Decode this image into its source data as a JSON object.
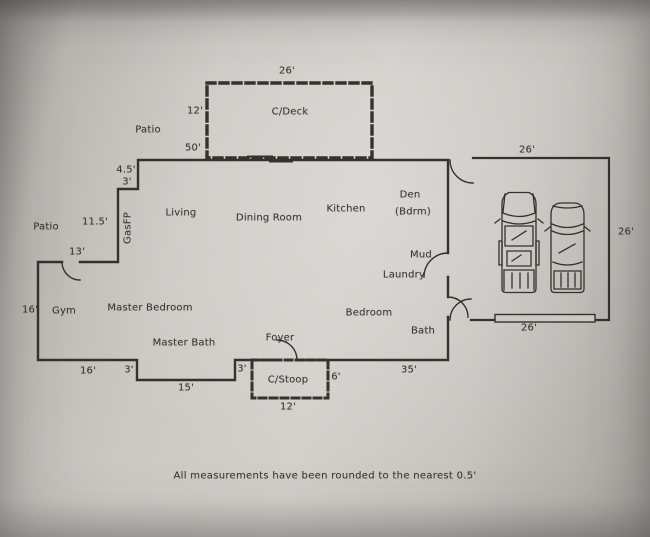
{
  "meta": {
    "disclaimer": "All measurements have been rounded to the nearest  0.5'",
    "palette": {
      "ink": "#37342f",
      "paper": "#ccc9c4"
    },
    "icons": {
      "vehicle_left": "pickup-truck-top-view-icon",
      "vehicle_right": "suv-top-view-icon",
      "doors": "quarter-arc-door-swing"
    }
  },
  "rooms": [
    {
      "id": "patio-top",
      "label": "Patio"
    },
    {
      "id": "c-deck",
      "label": "C/Deck"
    },
    {
      "id": "living",
      "label": "Living"
    },
    {
      "id": "dining-room",
      "label": "Dining Room"
    },
    {
      "id": "kitchen",
      "label": "Kitchen"
    },
    {
      "id": "den-line1",
      "label": "Den"
    },
    {
      "id": "den-line2",
      "label": "(Bdrm)"
    },
    {
      "id": "patio-left",
      "label": "Patio"
    },
    {
      "id": "gym",
      "label": "Gym"
    },
    {
      "id": "master-bedroom",
      "label": "Master Bedroom"
    },
    {
      "id": "master-bath",
      "label": "Master Bath"
    },
    {
      "id": "mud",
      "label": "Mud"
    },
    {
      "id": "laundry",
      "label": "Laundry"
    },
    {
      "id": "bedroom",
      "label": "Bedroom"
    },
    {
      "id": "bath",
      "label": "Bath"
    },
    {
      "id": "foyer",
      "label": "Foyer"
    },
    {
      "id": "c-stoop",
      "label": "C/Stoop"
    },
    {
      "id": "gas-fireplace",
      "label": "GasFP"
    }
  ],
  "measurements": [
    {
      "of": "deck-width",
      "label": "26'"
    },
    {
      "of": "deck-depth",
      "label": "12'"
    },
    {
      "of": "house-top-wall",
      "label": "50'"
    },
    {
      "of": "step-vertical",
      "label": "4.5'"
    },
    {
      "of": "step-horizontal",
      "label": "3'"
    },
    {
      "of": "patio-left-wall",
      "label": "11.5'"
    },
    {
      "of": "gym-top-wall",
      "label": "13'"
    },
    {
      "of": "gym-left-wall",
      "label": "16'"
    },
    {
      "of": "bottom-left-wall",
      "label": "16'"
    },
    {
      "of": "bottom-step-left",
      "label": "3'"
    },
    {
      "of": "bottom-recess",
      "label": "15'"
    },
    {
      "of": "bottom-step-right",
      "label": "3'"
    },
    {
      "of": "stoop-depth",
      "label": "6'"
    },
    {
      "of": "stoop-width",
      "label": "12'"
    },
    {
      "of": "bottom-right-wall",
      "label": "35'"
    },
    {
      "of": "garage-top",
      "label": "26'"
    },
    {
      "of": "garage-right",
      "label": "26'"
    },
    {
      "of": "garage-bottom",
      "label": "26'"
    }
  ]
}
